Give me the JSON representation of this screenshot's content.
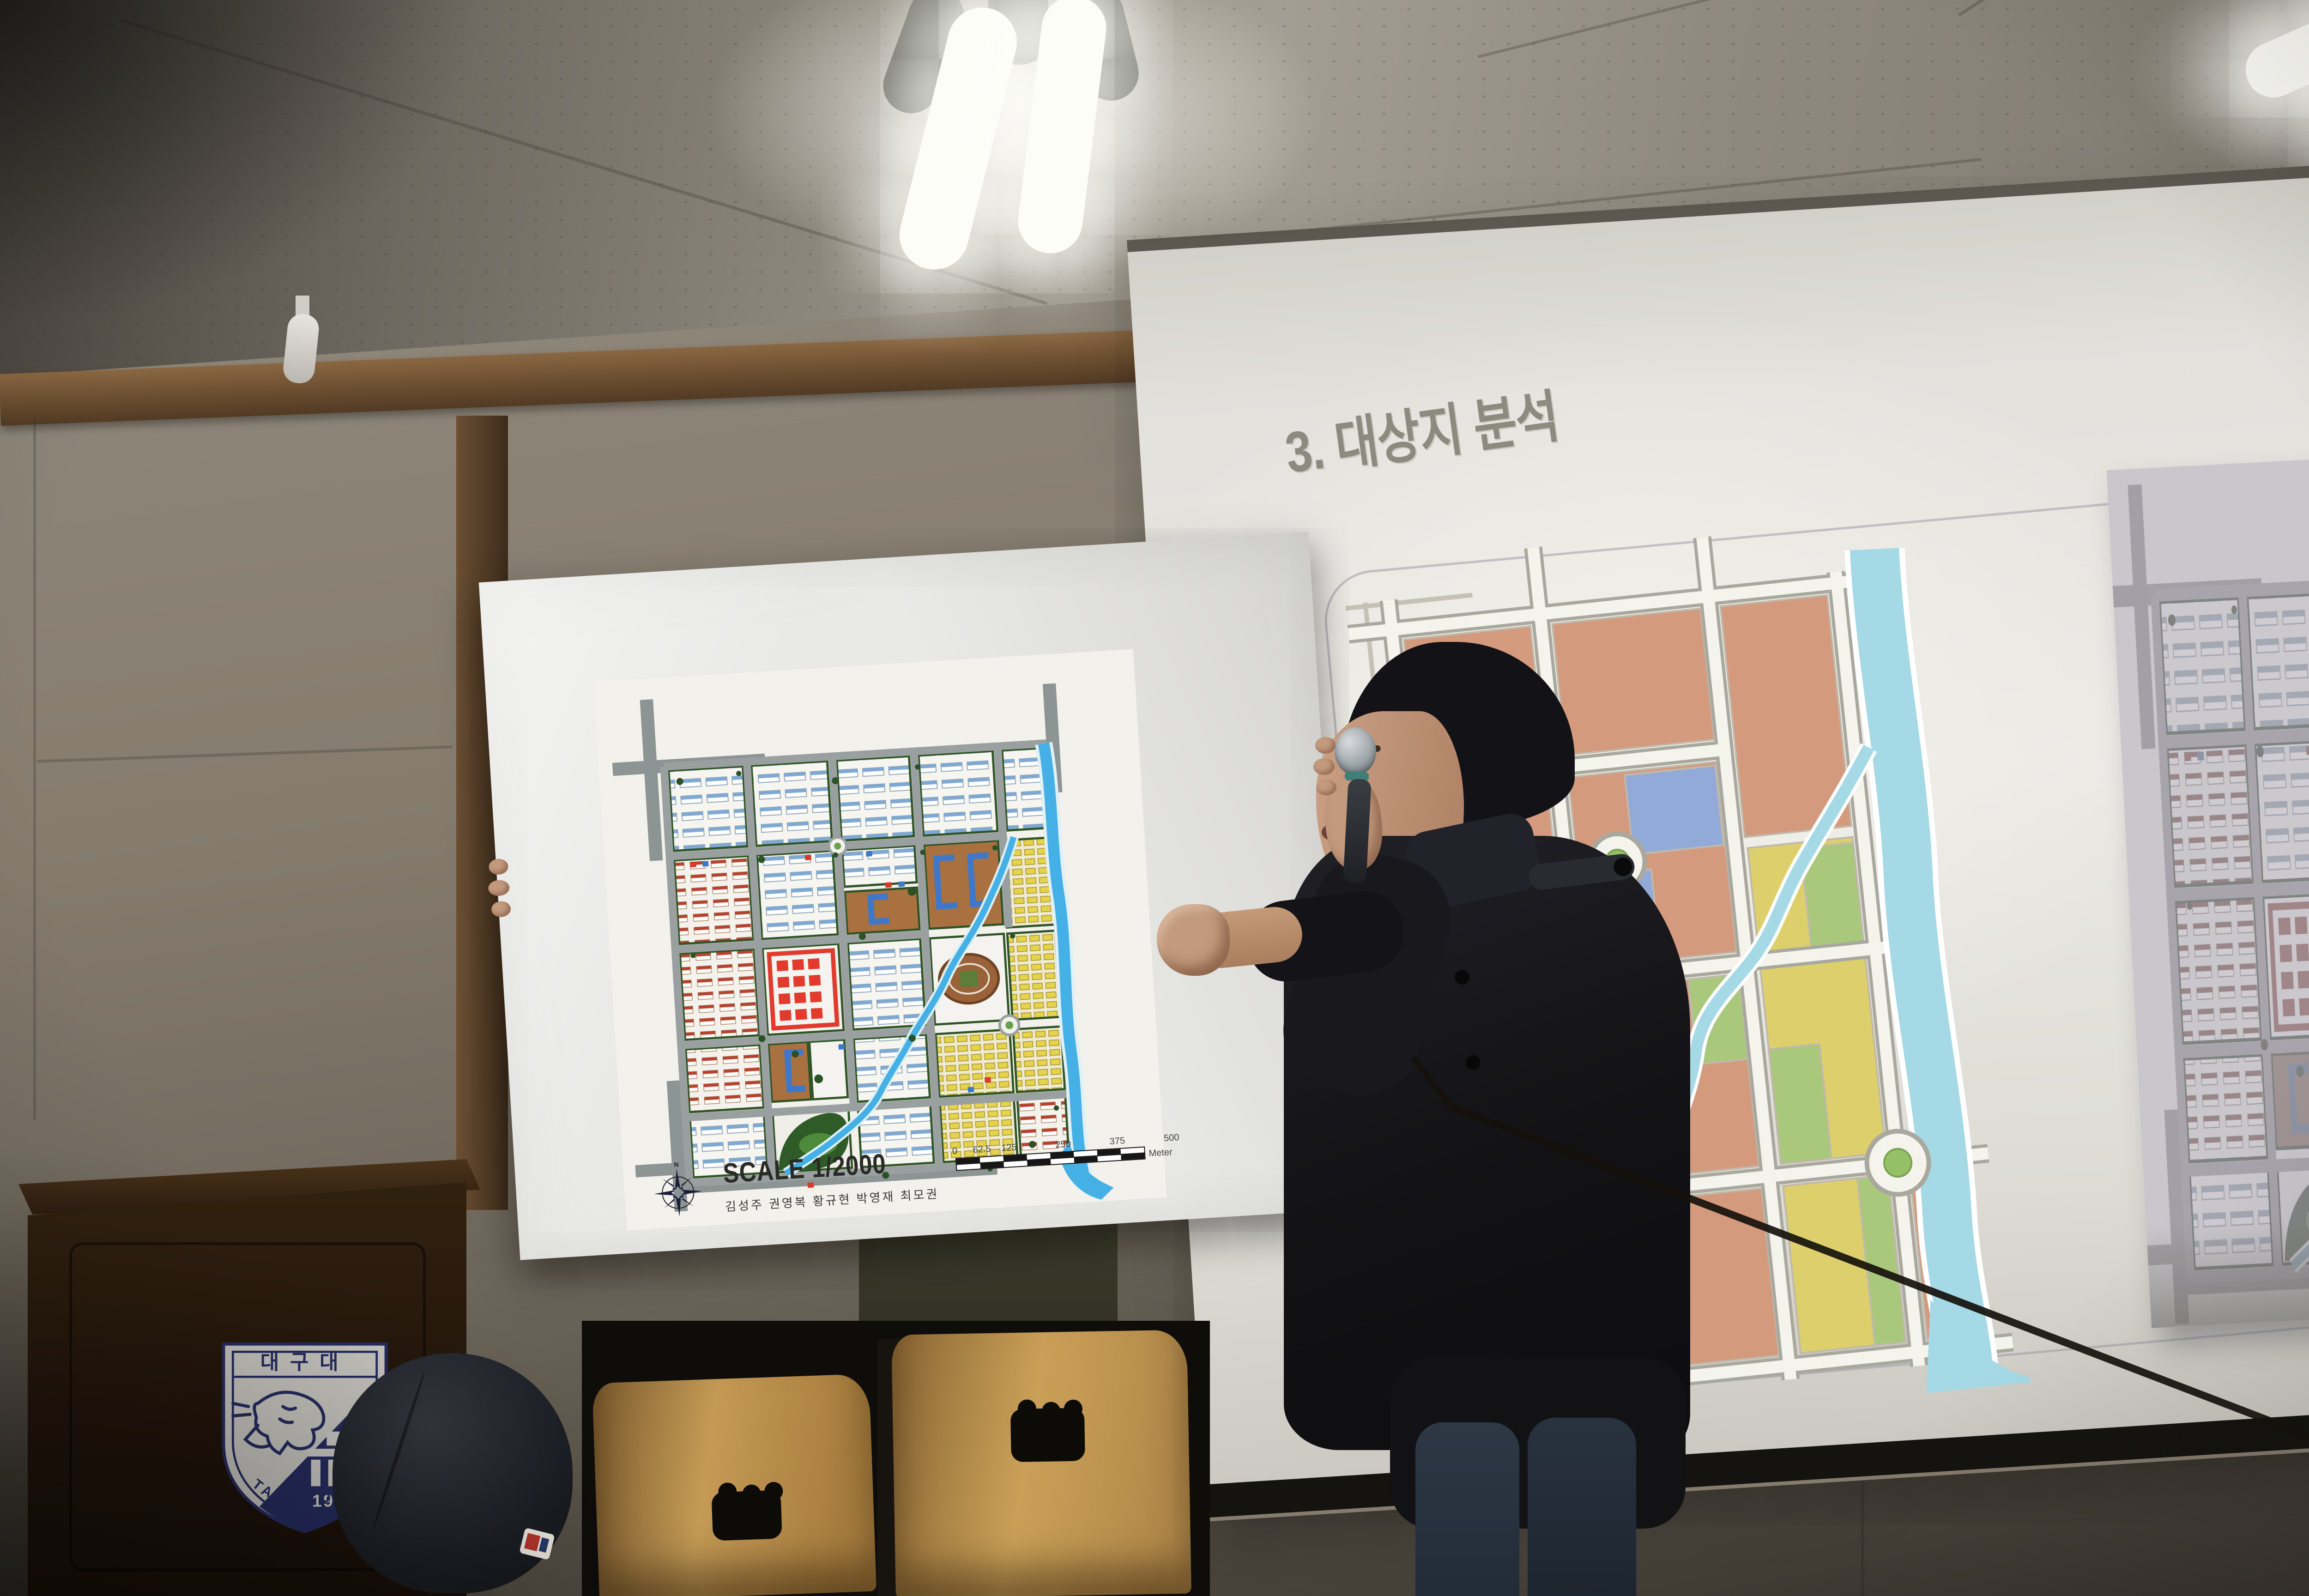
{
  "scene": {
    "slide": {
      "title": "3. 대상지 분석"
    },
    "poster": {
      "scale_label": "SCALE 1/2000",
      "authors": "김성주 권영복 황규현 박영재 최모권",
      "north_label": "N",
      "scalebar": {
        "labels": [
          "0",
          "62.5",
          "125",
          "250",
          "375",
          "500"
        ],
        "unit": "Meter"
      }
    },
    "emblem": {
      "top_text": "대구대",
      "year": "1956",
      "arc_text": "TAEGU UNIVE"
    },
    "palette": {
      "ceiling": "#8f8a7f",
      "wall": "#857c6e",
      "wallDark": "#3e3a33",
      "woodTrim": "#6f5436",
      "screen": "#e7e5e0",
      "slideTitle": "#8b8b7f",
      "mapSalmon": "#d49a7d",
      "mapBlue": "#92aad8",
      "mapYellow": "#ddd06c",
      "mapGreen": "#a9c87c",
      "mapRiver": "#a5d9e6",
      "roadWhite": "#f4f3ec",
      "roadGray": "#a8a89e",
      "posterWhite": "#e9e9e6",
      "planRed": "#e23b2e",
      "planBrown": "#a9713f",
      "planBlue": "#3f78c8",
      "planGreen": "#2f5426",
      "riverBlue": "#45b0e6",
      "chairWood": "#c49a55",
      "coat": "#17171b",
      "skin": "#c39a7d",
      "jeans": "#2a3342",
      "podium": "#2a1b10",
      "emblemNavy": "#2c3270",
      "cable": "#15110c"
    }
  }
}
